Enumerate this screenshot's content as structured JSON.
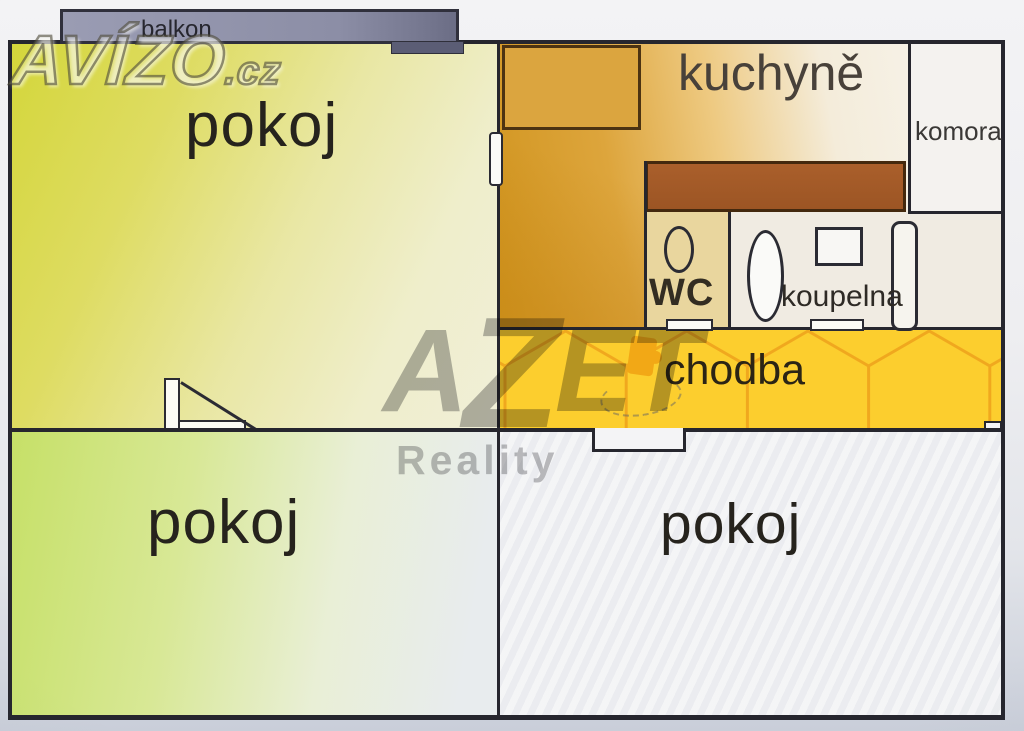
{
  "title": "apartment floor plan",
  "branding": {
    "avizo": "AVÍZO",
    "avizo_tld": ".cz",
    "azet_a": "A",
    "azet_z": "Z",
    "azet_et": "ET",
    "azet_sub": "Reality"
  },
  "rooms": {
    "balcony": {
      "label": "balkon"
    },
    "room_top_left": {
      "label": "pokoj"
    },
    "kitchen": {
      "label": "kuchyně"
    },
    "pantry": {
      "label": "komora"
    },
    "wc": {
      "label": "WC"
    },
    "bathroom": {
      "label": "koupelna"
    },
    "hallway": {
      "label": "chodba"
    },
    "room_bottom_left": {
      "label": "pokoj"
    },
    "room_bottom_right": {
      "label": "pokoj"
    }
  },
  "colors": {
    "wall": "#26262e",
    "hall_yellow": "#fcce2e",
    "hall_tile_line": "#f0a81e",
    "counter_brown": "#a25a28",
    "balcony_gray": "#8f91a9",
    "room_top_left_yellow": "#d4d63a",
    "room_bottom_left_green": "#c6e067",
    "kitchen_orange": "#d89d2e",
    "wc_tan": "#e9d69e"
  }
}
